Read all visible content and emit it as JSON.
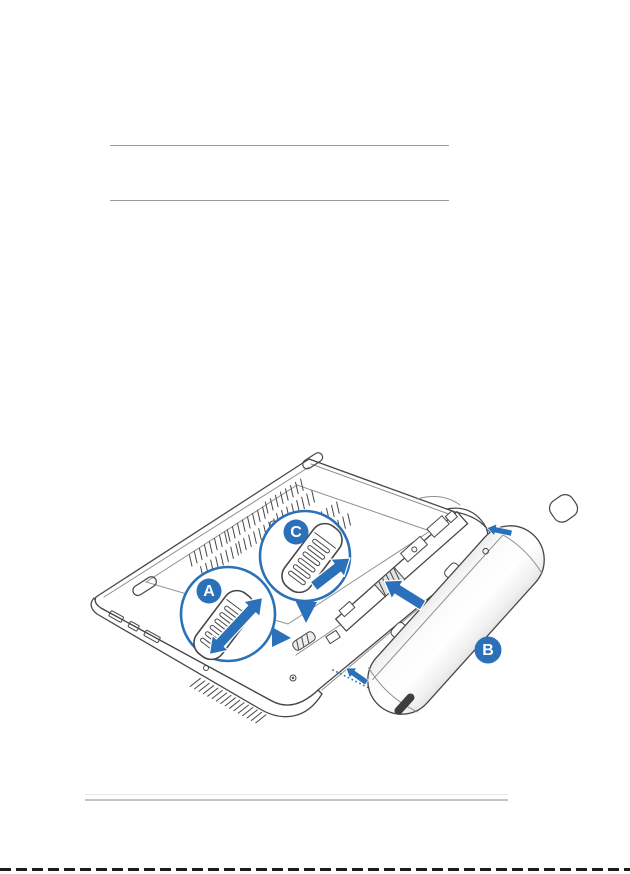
{
  "theme": {
    "page-bg": "#ffffff",
    "accent": "#2b71b9",
    "ink": "#474747",
    "ink-soft": "#8f8f8f",
    "rule-top": "#9c9c9c",
    "rule-bottom": "#c4c4c4",
    "rule-bottom-faint": "#e6e6e6",
    "edge-dash": "#1c1c1c",
    "battery-shade": "#e7e7e7"
  },
  "figure": {
    "callouts": {
      "a": "A",
      "b": "B",
      "c": "C"
    }
  }
}
